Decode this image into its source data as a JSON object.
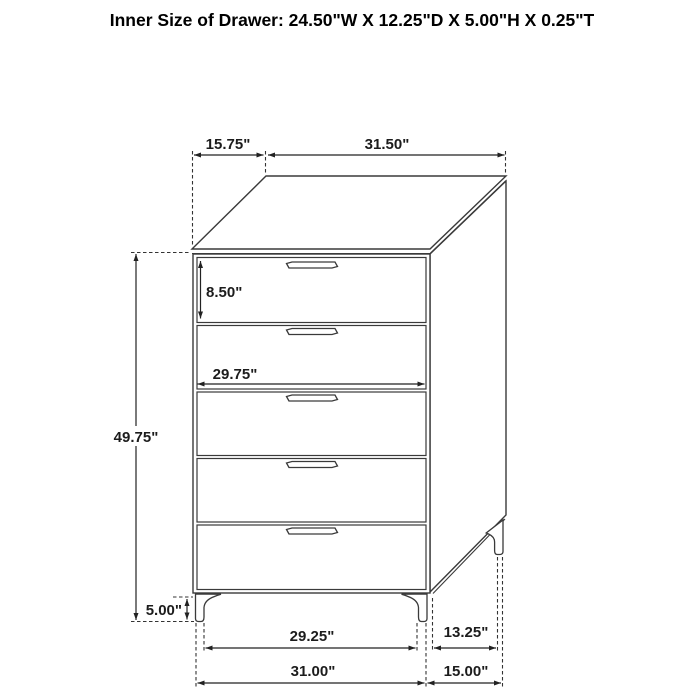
{
  "title": "Inner Size of Drawer: 24.50\"W X 12.25\"D X 5.00\"H X 0.25\"T",
  "figure": {
    "type": "furniture-dimension-diagram",
    "item": "5-drawer chest",
    "drawer_count": 5
  },
  "dimensions": {
    "top_depth": "15.75\"",
    "top_width": "31.50\"",
    "top_drawer_inner_height": "8.50\"",
    "drawer_front_width": "29.75\"",
    "overall_height": "49.75\"",
    "leg_height": "5.00\"",
    "front_legs_span": "29.25\"",
    "base_width": "31.00\"",
    "side_legs_span": "13.25\"",
    "base_depth": "15.00\""
  },
  "colors": {
    "background": "#ffffff",
    "line": "#3a3a3a",
    "dimension_line": "#222222",
    "text": "#1c1c1c"
  }
}
